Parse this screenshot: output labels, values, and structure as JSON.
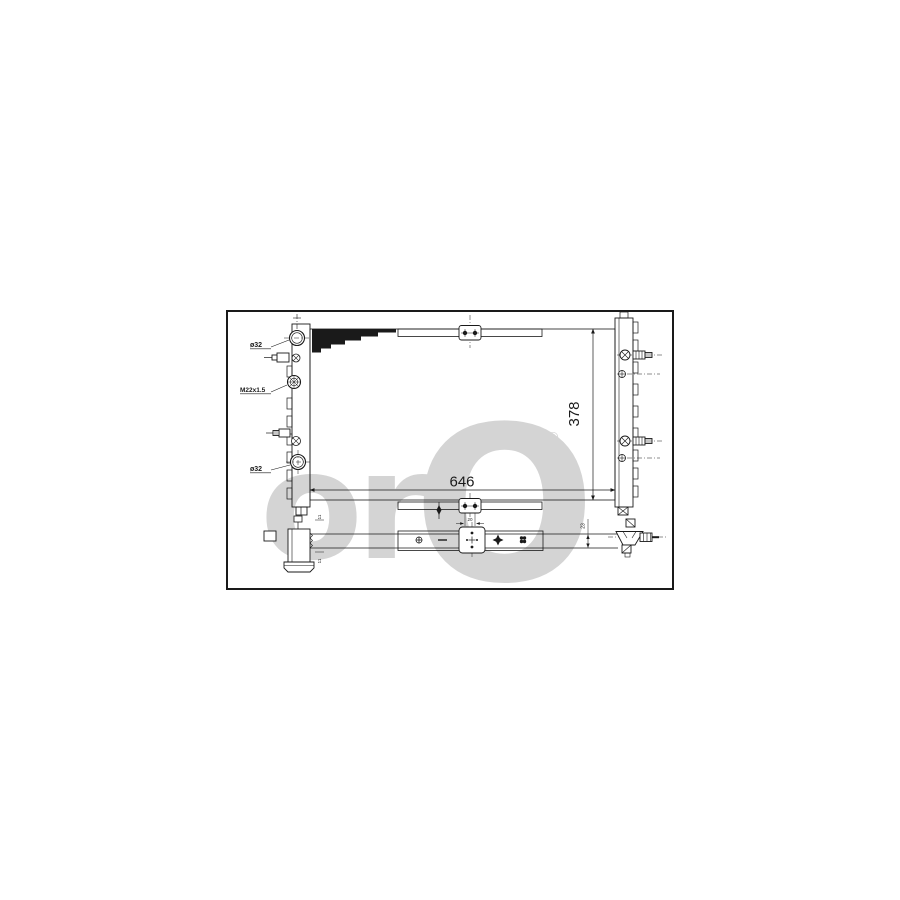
{
  "drawing": {
    "labels": {
      "inlet_diameter": "ø32",
      "filler_thread": "M22x1.5",
      "outlet_diameter": "ø32"
    },
    "dimensions": {
      "core_width": "646",
      "core_height": "378",
      "bracket_hole_spacing": "20",
      "pipe_offset_top": "11",
      "pipe_offset_bottom": "11",
      "connector_offset": "23"
    },
    "watermark": {
      "text_small": "or",
      "text_big": "O",
      "registered_mark": "®"
    },
    "colors": {
      "line": "#1a1a1a",
      "watermark": "#d4d4d4",
      "background": "#ffffff"
    }
  }
}
